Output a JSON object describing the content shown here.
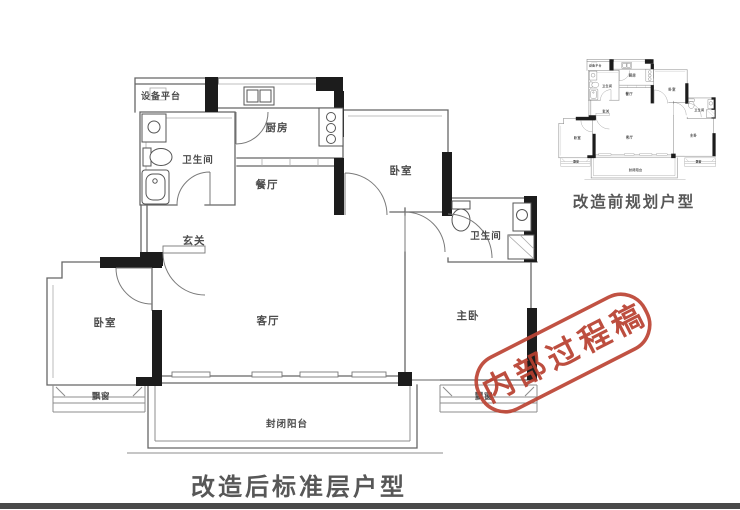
{
  "page": {
    "background": "#ffffff",
    "footer_bar_color": "#4a4a4a"
  },
  "plan": {
    "caption_main": "改造后标准层户型",
    "caption_mini": "改造前规划户型",
    "rooms": {
      "equipment_platform": "设备平台",
      "bathroom_1": "卫生间",
      "kitchen": "厨房",
      "dining": "餐厅",
      "hall": "玄关",
      "bedroom_top": "卧室",
      "bathroom_2": "卫生间",
      "master_bedroom": "主卧",
      "bedroom_left": "卧室",
      "living": "客厅",
      "bay_window_left": "飘窗",
      "bay_window_right": "飘窗",
      "balcony": "封闭阳台"
    },
    "colors": {
      "wall": "#1c1c1c",
      "thin_line": "#666666",
      "label": "#4c4c4c",
      "caption": "#575757"
    }
  },
  "stamp": {
    "text": "内部过程稿",
    "color": "#bb4233"
  }
}
